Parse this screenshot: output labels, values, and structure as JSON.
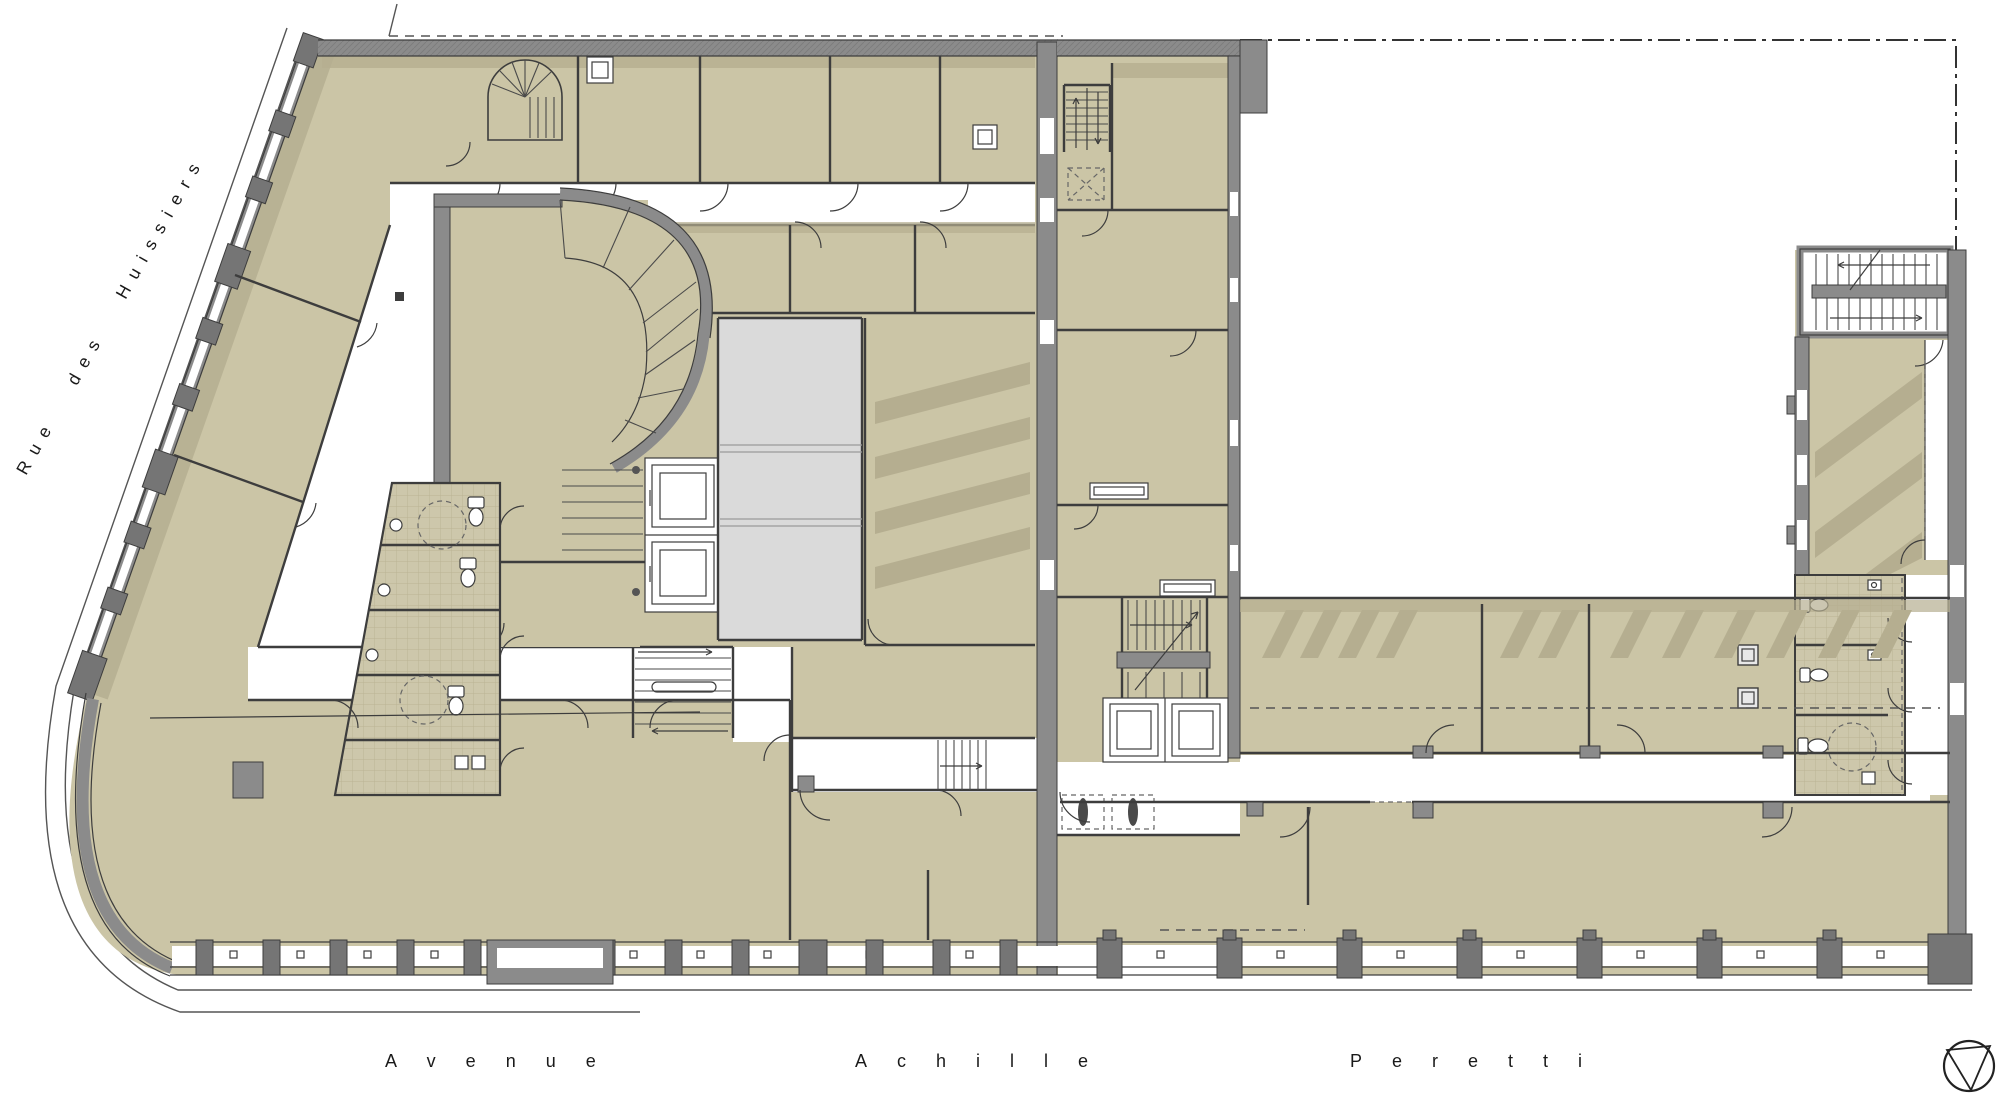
{
  "plan": {
    "type": "architectural-floor-plan",
    "drawing_style": "color-rendered plan: tan rooms, gray walls, white circulation"
  },
  "streets": {
    "left": {
      "name": "Rue des Huissiers",
      "words": [
        "Rue",
        "des",
        "Huissiers"
      ],
      "orientation": "rotated along angled west facade"
    },
    "bottom": {
      "name": "Avenue Achille Peretti",
      "words": [
        "Avenue",
        "Achille",
        "Peretti"
      ],
      "orientation": "horizontal along south facade"
    }
  },
  "compass": {
    "name": "north-arrow",
    "shape": "circle with inscribed triangle",
    "position": "bottom-right"
  },
  "site_lines": {
    "property_boundary": "dash-dot line, top right",
    "plot_dashed": "dashed line along top of left block",
    "sidewalk": "thin curb lines along both streets"
  },
  "features": {
    "elevators": 4,
    "staircases": 7,
    "wc_blocks": 2,
    "atrium_void": 1,
    "scooter_bays": 2,
    "skylight_hatched_rooms": 3
  },
  "symbols": {
    "elevator-icon": "double rectangle car in shaft",
    "wc-icon": "toilet bowl ellipse with cistern",
    "sink-icon": "small basin with tap circle",
    "stair-icon": "parallel treads with direction arrow",
    "turning-circle-icon": "dashed accessibility circle",
    "scooter-icon": "dashed bay with two-wheeler",
    "north-arrow-icon": "circle with inscribed triangle"
  },
  "colors": {
    "background": "#ffffff",
    "room_fill": "#cbc5a6",
    "room_shade": "#b5ae90",
    "tile_floor": "#cdc7ab",
    "tile_grid": "#bab393",
    "wall_gray": "#8b8b8b",
    "pilaster_gray": "#757575",
    "wall_line": "#3d3d3d",
    "atrium_void": "#dadada",
    "site_line": "#555555",
    "text": "#1a1a1a"
  }
}
